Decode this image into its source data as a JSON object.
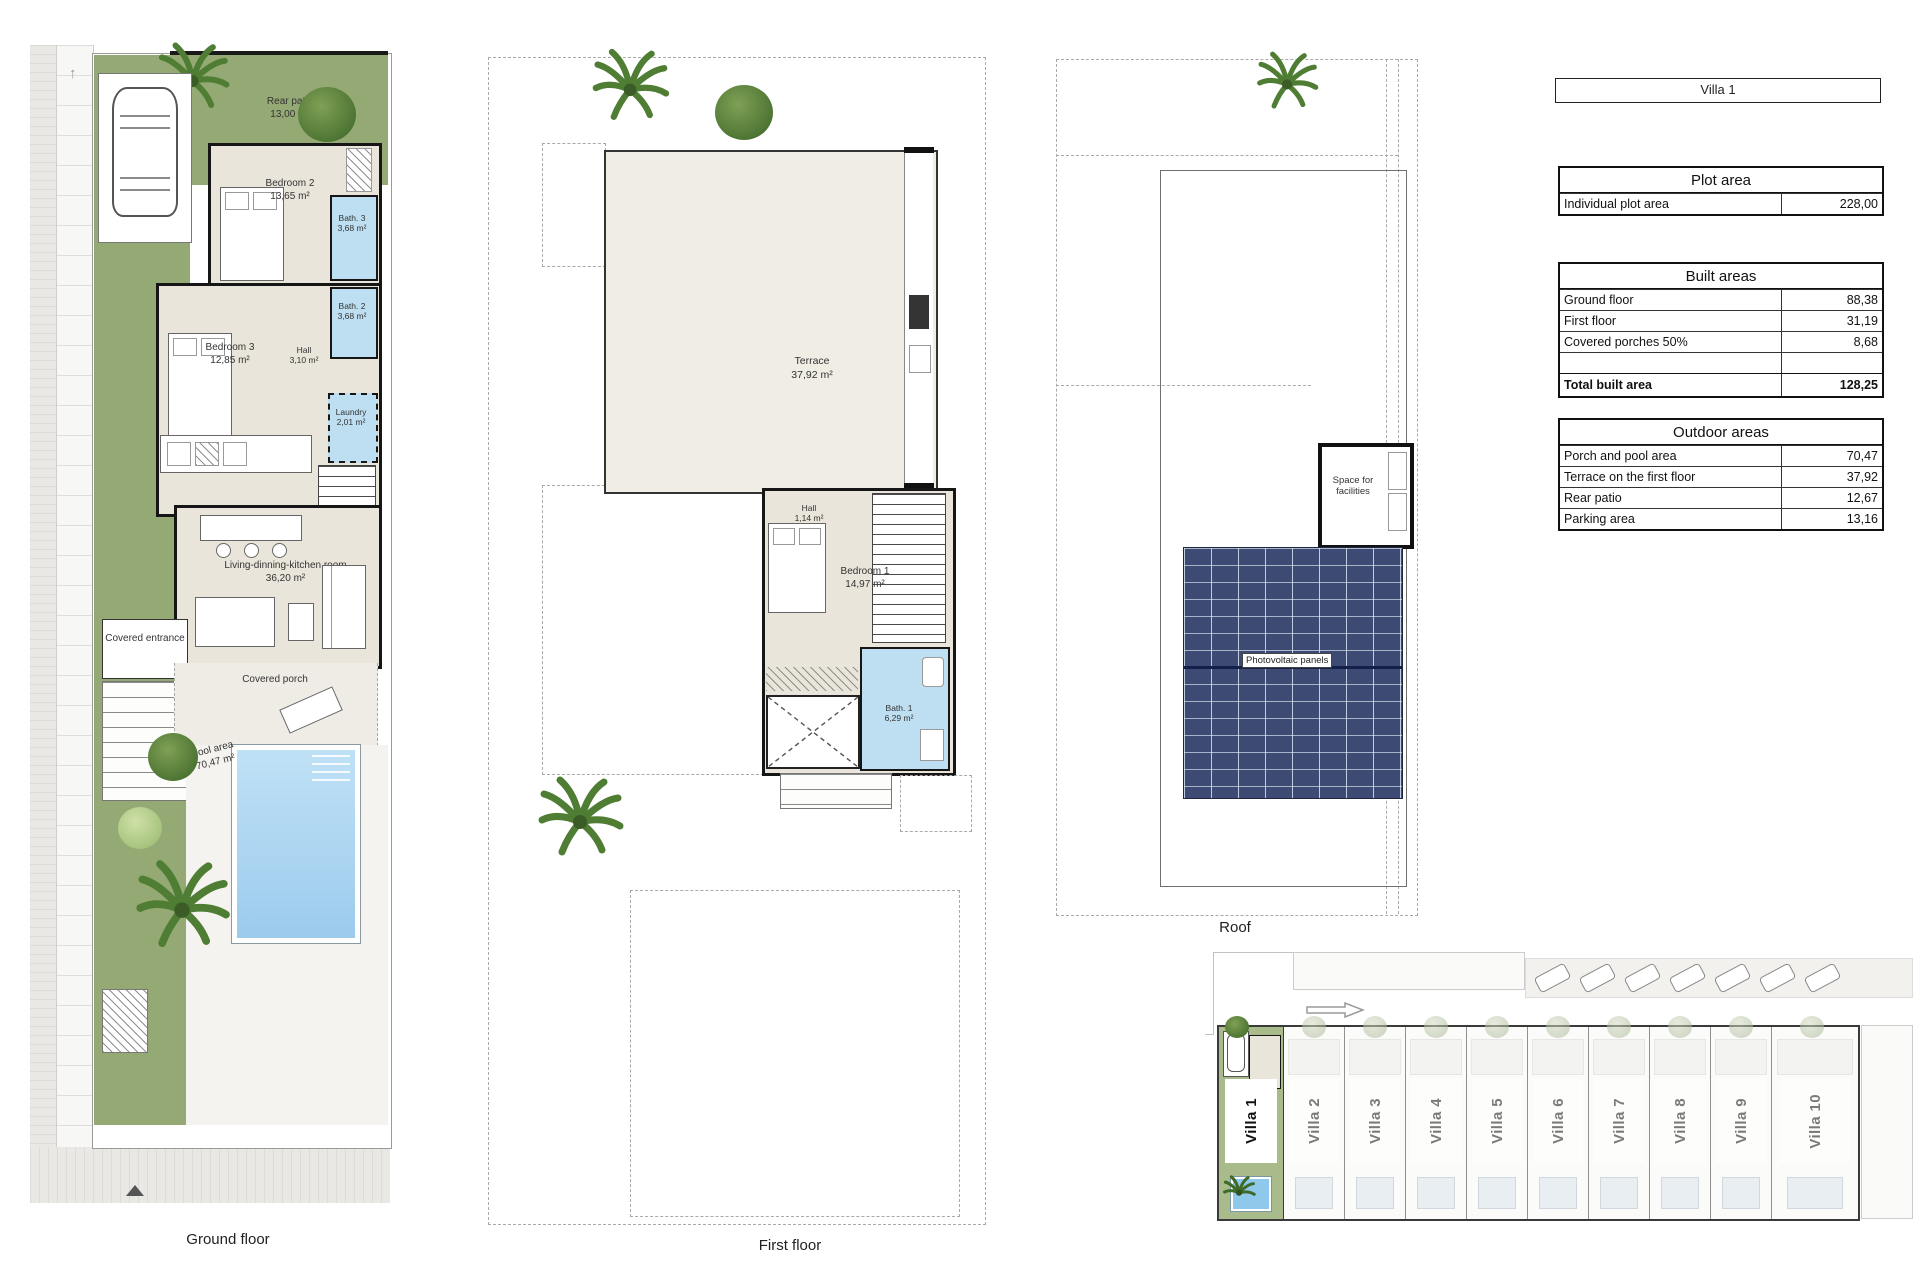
{
  "colors": {
    "garden_green": "#95a974",
    "interior_beige": "#eae5da",
    "wet_room_blue": "#bedff1",
    "pool_blue": "#9ccbed",
    "photovoltaic_navy": "#3c4a74",
    "wall_black": "#161616"
  },
  "ground_floor": {
    "caption": "Ground floor",
    "rooms": {
      "rear_patio": {
        "name": "Rear patio",
        "area": "13,00 m²"
      },
      "bedroom2": {
        "name": "Bedroom 2",
        "area": "13,65 m²"
      },
      "bath3": {
        "name": "Bath. 3",
        "area": "3,68 m²"
      },
      "bath2": {
        "name": "Bath. 2",
        "area": "3,68 m²"
      },
      "bedroom3": {
        "name": "Bedroom 3",
        "area": "12,85 m²"
      },
      "hall": {
        "name": "Hall",
        "area": "3,10 m²"
      },
      "laundry": {
        "name": "Laundry",
        "area": "2,01 m²"
      },
      "covered_entrance": {
        "name": "Covered entrance"
      },
      "living_kitchen": {
        "name": "Living-dinning-kitchen room",
        "area": "36,20 m²"
      },
      "covered_porch": {
        "name": "Covered porch"
      },
      "pool_area": {
        "name": "Pool area",
        "area": "70,47 m²"
      }
    }
  },
  "first_floor": {
    "caption": "First floor",
    "rooms": {
      "terrace": {
        "name": "Terrace",
        "area": "37,92 m²"
      },
      "hall": {
        "name": "Hall",
        "area": "1,14 m²"
      },
      "bedroom1": {
        "name": "Bedroom 1",
        "area": "14,97 m²"
      },
      "bath1": {
        "name": "Bath. 1",
        "area": "6,29 m²"
      }
    }
  },
  "roof": {
    "caption": "Roof",
    "space_for_facilities": "Space for facilities",
    "photovoltaic_panels": "Photovoltaic panels"
  },
  "info_panel": {
    "villa_title": "Villa 1",
    "plot_area": {
      "title": "Plot area",
      "rows": [
        {
          "label": "Individual plot area",
          "value": "228,00"
        }
      ]
    },
    "built_areas": {
      "title": "Built areas",
      "rows": [
        {
          "label": "Ground floor",
          "value": "88,38"
        },
        {
          "label": "First floor",
          "value": "31,19"
        },
        {
          "label": "Covered porches 50%",
          "value": "8,68"
        },
        {
          "label": "",
          "value": ""
        },
        {
          "label": "Total built area",
          "value": "128,25"
        }
      ]
    },
    "outdoor_areas": {
      "title": "Outdoor areas",
      "rows": [
        {
          "label": "Porch and pool area",
          "value": "70,47"
        },
        {
          "label": "Terrace on the first floor",
          "value": "37,92"
        },
        {
          "label": "Rear patio",
          "value": "12,67"
        },
        {
          "label": "Parking area",
          "value": "13,16"
        }
      ]
    }
  },
  "site_plan": {
    "villas": [
      {
        "label": "Villa 1"
      },
      {
        "label": "Villa 2"
      },
      {
        "label": "Villa 3"
      },
      {
        "label": "Villa 4"
      },
      {
        "label": "Villa 5"
      },
      {
        "label": "Villa 6"
      },
      {
        "label": "Villa 7"
      },
      {
        "label": "Villa 8"
      },
      {
        "label": "Villa 9"
      },
      {
        "label": "Villa 10"
      }
    ]
  }
}
